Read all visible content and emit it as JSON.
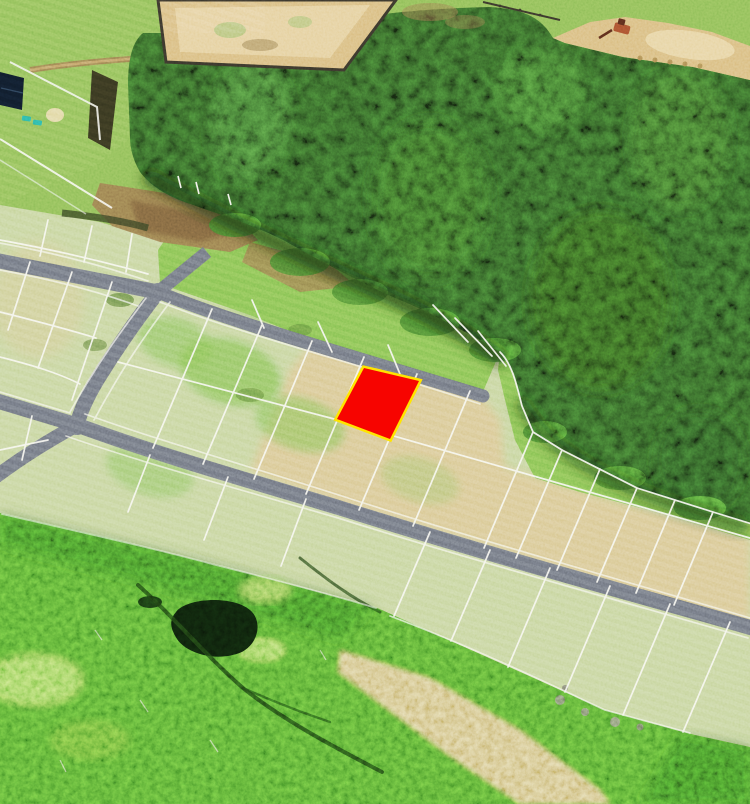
{
  "scene": {
    "kind": "aerial-photo-land-plot-map",
    "highlight_plot": {
      "fill": "#f70400",
      "border": "#ffe400"
    },
    "colors": {
      "meadow": "#8fbe58",
      "subdivision_ground": "#c6d49c",
      "cleared_tan": "#d8c791",
      "sand_light": "#ead9ab",
      "bright_grass": "#85c152",
      "forest_base": "#2e5623",
      "forest_dark": "#16300f",
      "forest_light": "#4c8a33",
      "rough_green": "#4f9e2e",
      "rough_dark": "#2b611b",
      "rough_light": "#a2d862",
      "pond": "#0c1d0a",
      "road": "#6f747e",
      "plot_line": "#f7f7f0",
      "dirt": "#9b7b4f",
      "dirt_dark": "#6e5535",
      "sand": "#d9bd80",
      "fence_dark": "#39352b",
      "roof": "#101c2b",
      "teal_object": "#2bb2a1",
      "excavator": "#a8502f",
      "highlight_fill": "#f70400",
      "highlight_border": "#ffe400"
    }
  }
}
